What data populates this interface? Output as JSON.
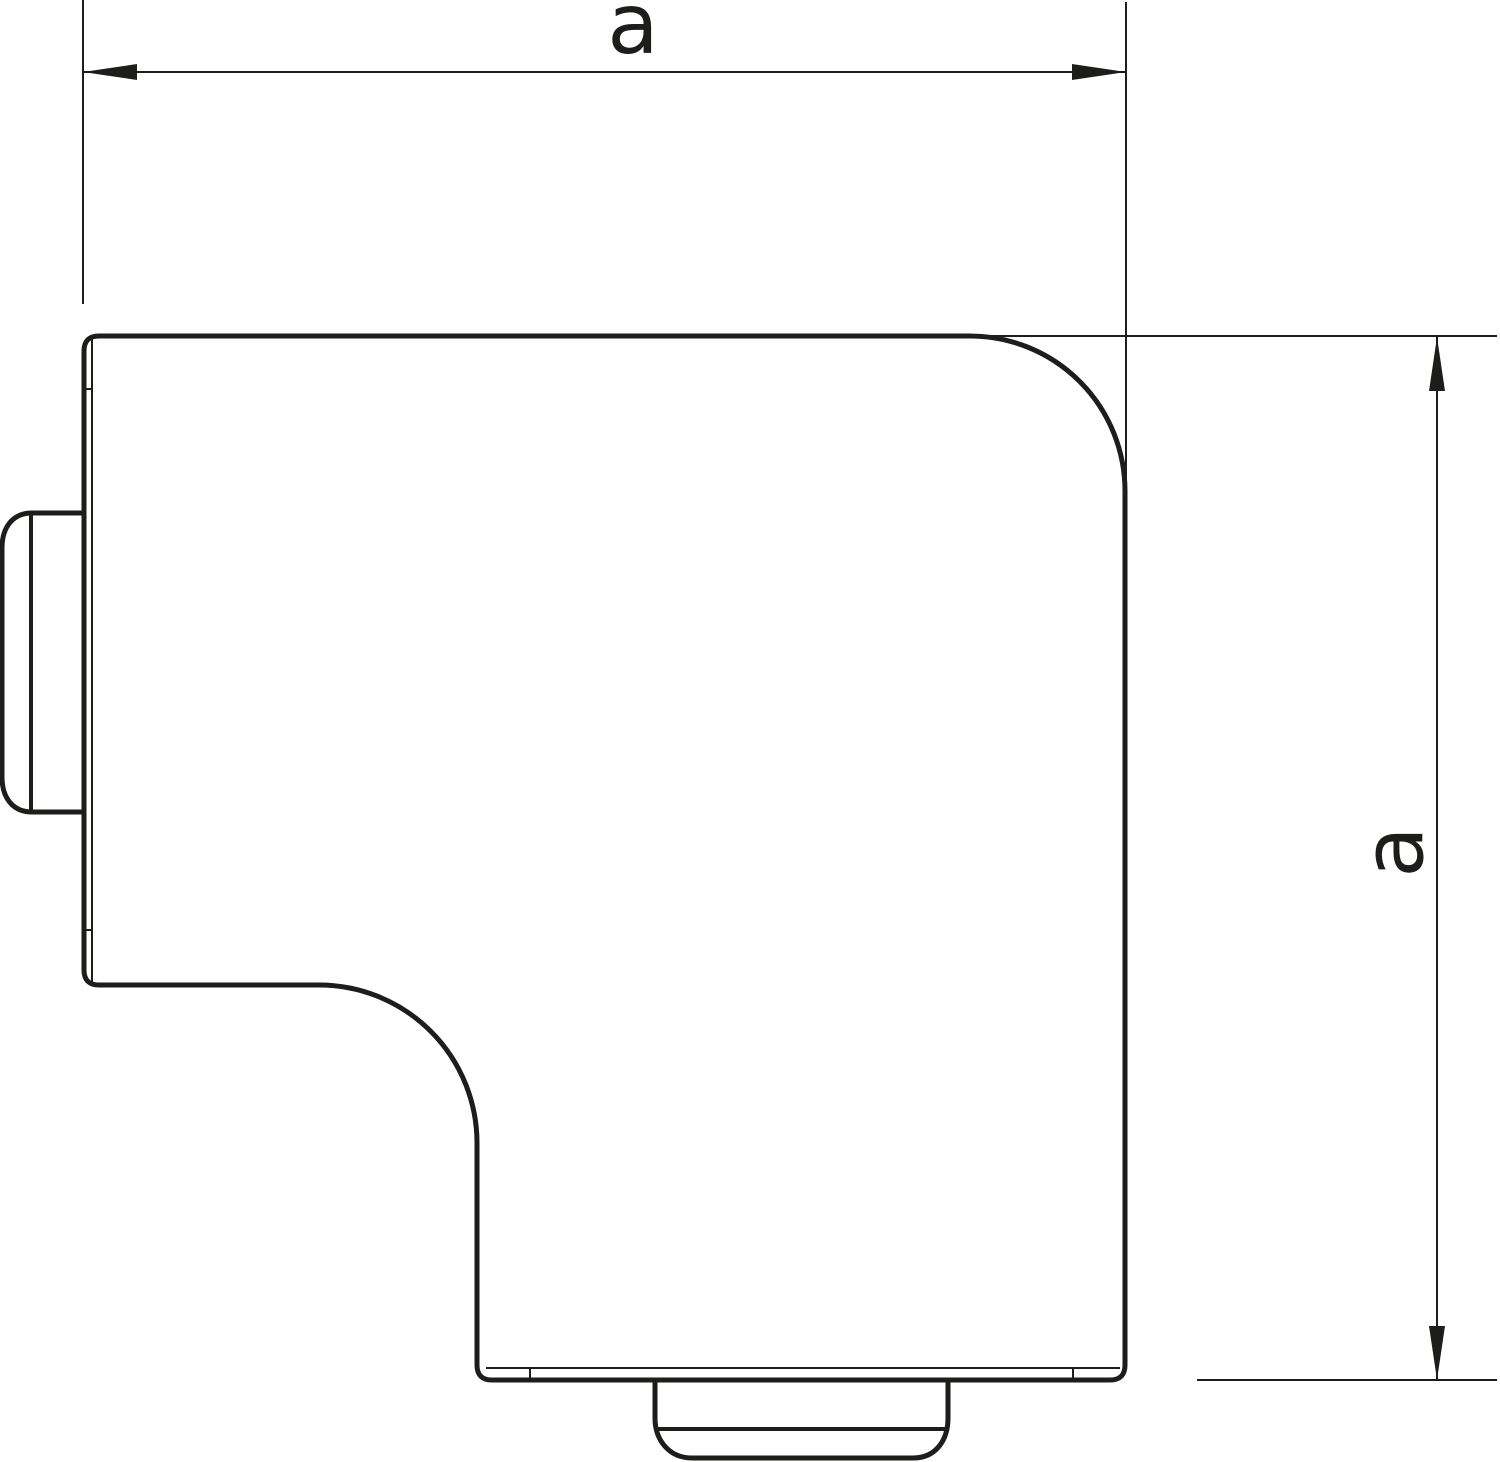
{
  "colors": {
    "line": "#1d1d1b",
    "background": "#ffffff"
  },
  "drawing": {
    "description": "Outline drawing of a flat-angle trunking cover with two equal dimension callouts",
    "dimension_width": {
      "label": "a"
    },
    "dimension_height": {
      "label": "a"
    }
  }
}
